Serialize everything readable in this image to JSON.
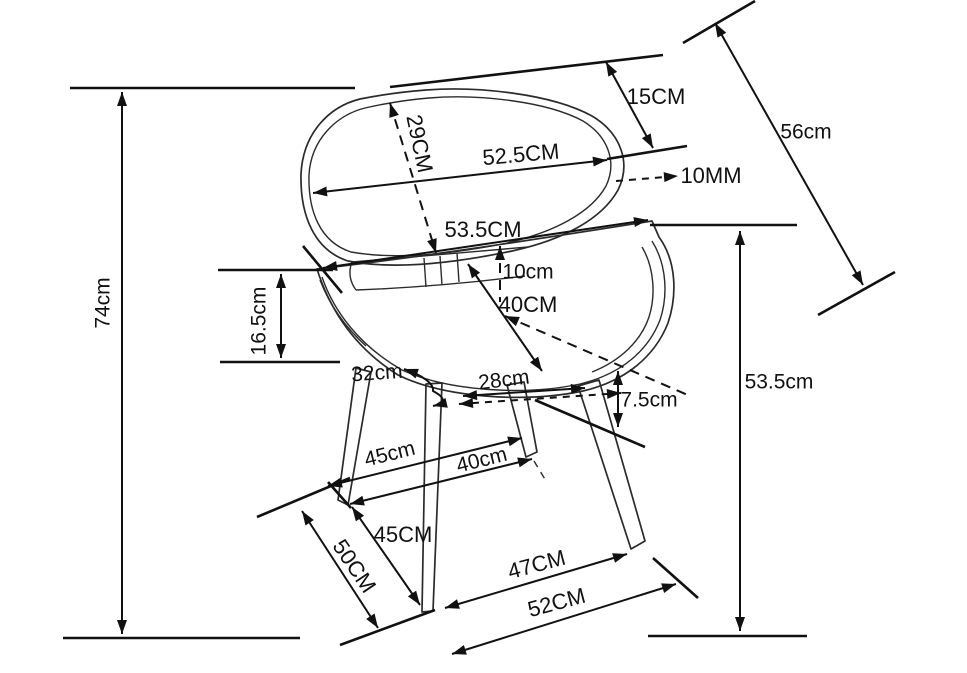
{
  "diagram": {
    "kind": "chair dimension drawing",
    "colors": {
      "ink": "#111111",
      "background": "#ffffff"
    },
    "dims": {
      "overall_height": {
        "label": "74cm"
      },
      "backrest_drop": {
        "label": "16.5cm"
      },
      "backrest_diagonal": {
        "label": "29CM"
      },
      "backrest_width": {
        "label": "52.5CM"
      },
      "backrest_top_offset": {
        "label": "15CM"
      },
      "backrest_length": {
        "label": "56cm"
      },
      "shell_thickness": {
        "label": "10MM"
      },
      "seat_width": {
        "label": "53.5CM"
      },
      "seat_back_overlap": {
        "label": "10cm"
      },
      "seat_depth": {
        "label": "40CM"
      },
      "seat_side": {
        "label": "32cm"
      },
      "leg_top_spacing": {
        "label": "28cm"
      },
      "seat_edge_drop": {
        "label": "7.5cm"
      },
      "seat_height": {
        "label": "53.5cm"
      },
      "leg_mid_span_left": {
        "label": "45cm"
      },
      "leg_mid_span_right": {
        "label": "40cm"
      },
      "front_leg_spacing": {
        "label": "45CM"
      },
      "leg_length": {
        "label": "50CM"
      },
      "base_depth": {
        "label": "47CM"
      },
      "base_width": {
        "label": "52CM"
      }
    }
  }
}
